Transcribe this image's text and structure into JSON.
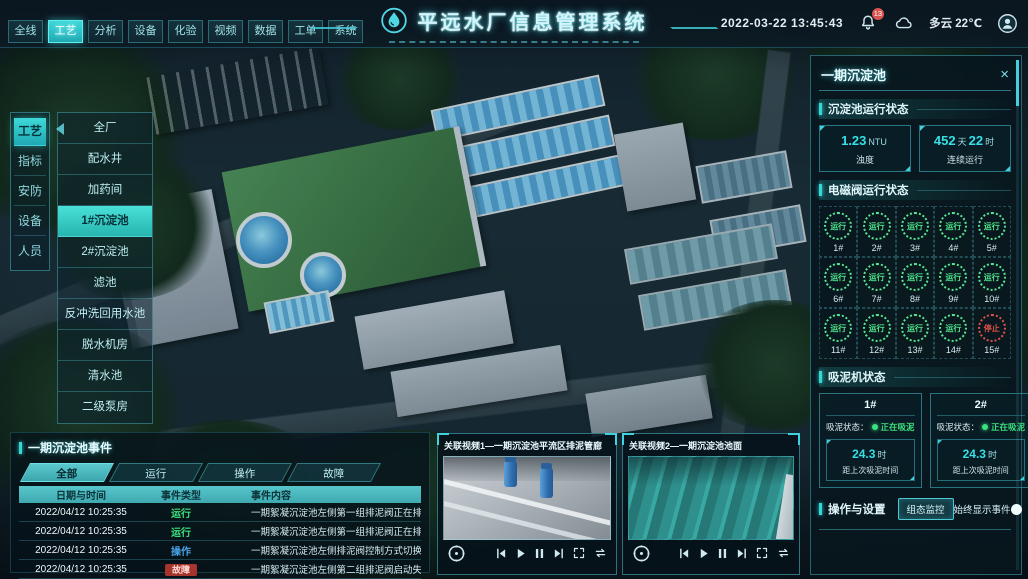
{
  "header": {
    "title": "平远水厂信息管理系统",
    "datetime": "2022-03-22 13:45:43",
    "notification_badge": "13",
    "weather": "多云 22℃",
    "nav": [
      {
        "label": "全线",
        "active": false
      },
      {
        "label": "工艺",
        "active": true
      },
      {
        "label": "分析",
        "active": false
      },
      {
        "label": "设备",
        "active": false
      },
      {
        "label": "化验",
        "active": false
      },
      {
        "label": "视频",
        "active": false
      },
      {
        "label": "数据",
        "active": false
      },
      {
        "label": "工单",
        "active": false
      },
      {
        "label": "系统",
        "active": false
      }
    ],
    "icons": {
      "logo": "water-drop-in-circle",
      "notifications": "bell",
      "weather": "cloud",
      "user": "avatar-person"
    }
  },
  "side_tabs": [
    {
      "label": "工艺",
      "active": true
    },
    {
      "label": "指标",
      "active": false
    },
    {
      "label": "安防",
      "active": false
    },
    {
      "label": "设备",
      "active": false
    },
    {
      "label": "人员",
      "active": false
    }
  ],
  "area_menu": [
    {
      "label": "全厂",
      "active": false
    },
    {
      "label": "配水井",
      "active": false
    },
    {
      "label": "加药间",
      "active": false
    },
    {
      "label": "1#沉淀池",
      "active": true
    },
    {
      "label": "2#沉淀池",
      "active": false
    },
    {
      "label": "滤池",
      "active": false
    },
    {
      "label": "反冲洗回用水池",
      "active": false
    },
    {
      "label": "脱水机房",
      "active": false
    },
    {
      "label": "清水池",
      "active": false
    },
    {
      "label": "二级泵房",
      "active": false
    }
  ],
  "right_panel": {
    "title": "一期沉淀池",
    "close_glyph": "×",
    "run_status": {
      "title": "沉淀池运行状态",
      "turbidity": {
        "value": "1.23",
        "unit": "NTU",
        "label": "浊度"
      },
      "uptime": {
        "v1": "452",
        "u1": "天",
        "v2": "22",
        "u2": "时",
        "label": "连续运行"
      }
    },
    "valves": {
      "title": "电磁阀运行状态",
      "items": [
        {
          "id": "1#",
          "status": "运行",
          "state": "run"
        },
        {
          "id": "2#",
          "status": "运行",
          "state": "run"
        },
        {
          "id": "3#",
          "status": "运行",
          "state": "run"
        },
        {
          "id": "4#",
          "status": "运行",
          "state": "run"
        },
        {
          "id": "5#",
          "status": "运行",
          "state": "run"
        },
        {
          "id": "6#",
          "status": "运行",
          "state": "run"
        },
        {
          "id": "7#",
          "status": "运行",
          "state": "run"
        },
        {
          "id": "8#",
          "status": "运行",
          "state": "run"
        },
        {
          "id": "9#",
          "status": "运行",
          "state": "run"
        },
        {
          "id": "10#",
          "status": "运行",
          "state": "run"
        },
        {
          "id": "11#",
          "status": "运行",
          "state": "run"
        },
        {
          "id": "12#",
          "status": "运行",
          "state": "run"
        },
        {
          "id": "13#",
          "status": "运行",
          "state": "run"
        },
        {
          "id": "14#",
          "status": "运行",
          "state": "run"
        },
        {
          "id": "15#",
          "status": "停止",
          "state": "stop"
        }
      ]
    },
    "mud_machines": {
      "title": "吸泥机状态",
      "cards": [
        {
          "id": "1#",
          "status_label": "吸泥状态：",
          "status": "正在吸泥",
          "value": "24.3",
          "unit": "时",
          "label": "距上次吸泥时间"
        },
        {
          "id": "2#",
          "status_label": "吸泥状态：",
          "status": "正在吸泥",
          "value": "24.3",
          "unit": "时",
          "label": "距上次吸泥时间"
        }
      ]
    },
    "operations": {
      "title": "操作与设置",
      "button_label": "组态监控",
      "toggle_label": "始终显示事件：",
      "toggle_on": true
    }
  },
  "events_panel": {
    "title": "一期沉淀池事件",
    "tabs": [
      {
        "label": "全部",
        "active": true
      },
      {
        "label": "运行",
        "active": false
      },
      {
        "label": "操作",
        "active": false
      },
      {
        "label": "故障",
        "active": false
      }
    ],
    "columns": [
      "日期与时间",
      "事件类型",
      "事件内容"
    ],
    "rows": [
      {
        "time": "2022/04/12 10:25:35",
        "type": "运行",
        "type_class": "run",
        "content": "一期絮凝沉淀池左侧第一组排泥阀正在排泥"
      },
      {
        "time": "2022/04/12 10:25:35",
        "type": "运行",
        "type_class": "run",
        "content": "一期絮凝沉淀池左侧第一组排泥阀正在排泥"
      },
      {
        "time": "2022/04/12 10:25:35",
        "type": "操作",
        "type_class": "op",
        "content": "一期絮凝沉淀池左侧排泥阀控制方式切换为手动"
      },
      {
        "time": "2022/04/12 10:25:35",
        "type": "故障",
        "type_class": "fault",
        "content": "一期絮凝沉淀池左侧第二组排泥阀启动失败"
      }
    ]
  },
  "videos": [
    {
      "title": "关联视频1—一期沉淀池平流区排泥管廊"
    },
    {
      "title": "关联视频2—一期沉淀池池面"
    }
  ],
  "video_control_icons": [
    "pan-control",
    "skip-back",
    "play",
    "pause",
    "skip-forward",
    "fullscreen",
    "loop"
  ],
  "colors": {
    "accent": "#3fd2de",
    "run_green": "#3ce07d",
    "stop_red": "#e0524a",
    "operate_blue": "#4aa3e8",
    "fault_badge": "#a5352c",
    "table_header": "#49b8bf"
  }
}
